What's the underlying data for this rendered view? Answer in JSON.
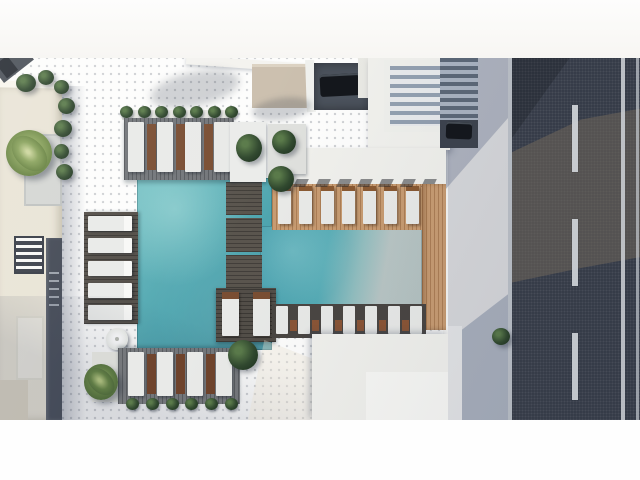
{
  "scene": {
    "description": "Aerial 3D architectural rendering of a residential amenity deck: two connected turquoise swimming pools with a slatted wood bridge and lounger island, gray and warm-wood sun decks lined with white chaise loungers, planters with palms and bushes, cream and white building rooftops with louvered skylights and parked cars, a concrete sidewalk and a dark asphalt road with lane markings",
    "letterbox": {
      "top_px": 58,
      "bottom_px": 60
    },
    "palette": {
      "ground": "#99a1ad",
      "pool_teal": "#4fa5af",
      "pool_glare": "#b9c6c5",
      "deck_gray": "#73767a",
      "deck_wood": "#c89c72",
      "building_cream": "#e9e4d6",
      "building_white": "#f1f1ed",
      "navy_roof": "#434955",
      "road": "#343a46",
      "marking": "#dde1e4",
      "sidewalk": "#d6d7da",
      "lounger": "#e9eae8",
      "lounger_wood": "#7a4e33",
      "plant_dark": "#31492f",
      "plant_light": "#8aa35d"
    },
    "counts": {
      "pools": 2,
      "bridge_steps": 3,
      "top_deck_loungers": 4,
      "left_deck_loungers": 5,
      "bottom_deck_loungers": 4,
      "pergola_loungers": 8,
      "lower_row_loungers": 7,
      "island_loungers": 2,
      "garland_plants": 7,
      "plant_row_plants": 6,
      "road_dashes": 3,
      "parked_cars": 2,
      "umbrellas": 1
    }
  }
}
